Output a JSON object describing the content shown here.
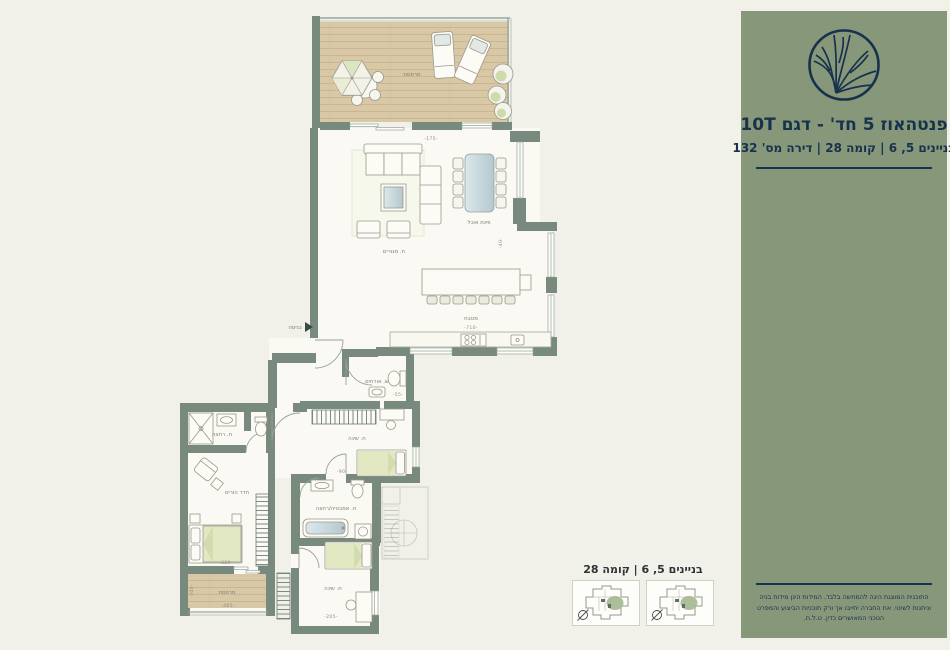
{
  "sidebar": {
    "title": "פנטהאוז 5 חד' - דגם 10T",
    "subtitle": "בניינים 5, 6 | קומה 28 | דירה מס' 132",
    "disclaimer": "התוכנית המוצגת הינה להמחשה בלבד. המידות הינן מידות בניה וניתנות לשינוי. את החברה יחייבו אך ורק תוכניות הביצוע והמפרט הטכני המאושרים כדין. ט.ל.ח.",
    "colors": {
      "bg": "#87977a",
      "ink": "#17324d"
    }
  },
  "keyplan": {
    "title": "בניינים 5, 6 | קומה 28"
  },
  "plan": {
    "labels": {
      "terrace_top": "מרפסת",
      "living": "ח. מגורים",
      "dining": "פינת אוכל",
      "kitchen": "מטבח",
      "entrance": "כניסה",
      "guest_wc": "ש. אורחים",
      "bedroom2": "ח. שינה",
      "bathroom": "ח. אמבטיה/רחצה",
      "bedroom3": "ח. שינה",
      "master_bath": "ח. רחצה",
      "master_bedroom": "חדר הורים",
      "terrace_master": "מרפסת"
    },
    "dims": {
      "living_top": "-175-",
      "kitchen": "-710-",
      "wc": "-55-",
      "bed2": "-90-",
      "bed3": "-205-",
      "master_terrace_top": "-320-",
      "master_terrace_bottom": "-485-",
      "master_terrace_side": "-300-",
      "terrace_side": "-65-",
      "right_side": "-40-"
    },
    "colors": {
      "wall": "#78897e",
      "deck": "#d8c7a3",
      "accent": "#dfe6c0",
      "water": "#c9d8da"
    }
  }
}
